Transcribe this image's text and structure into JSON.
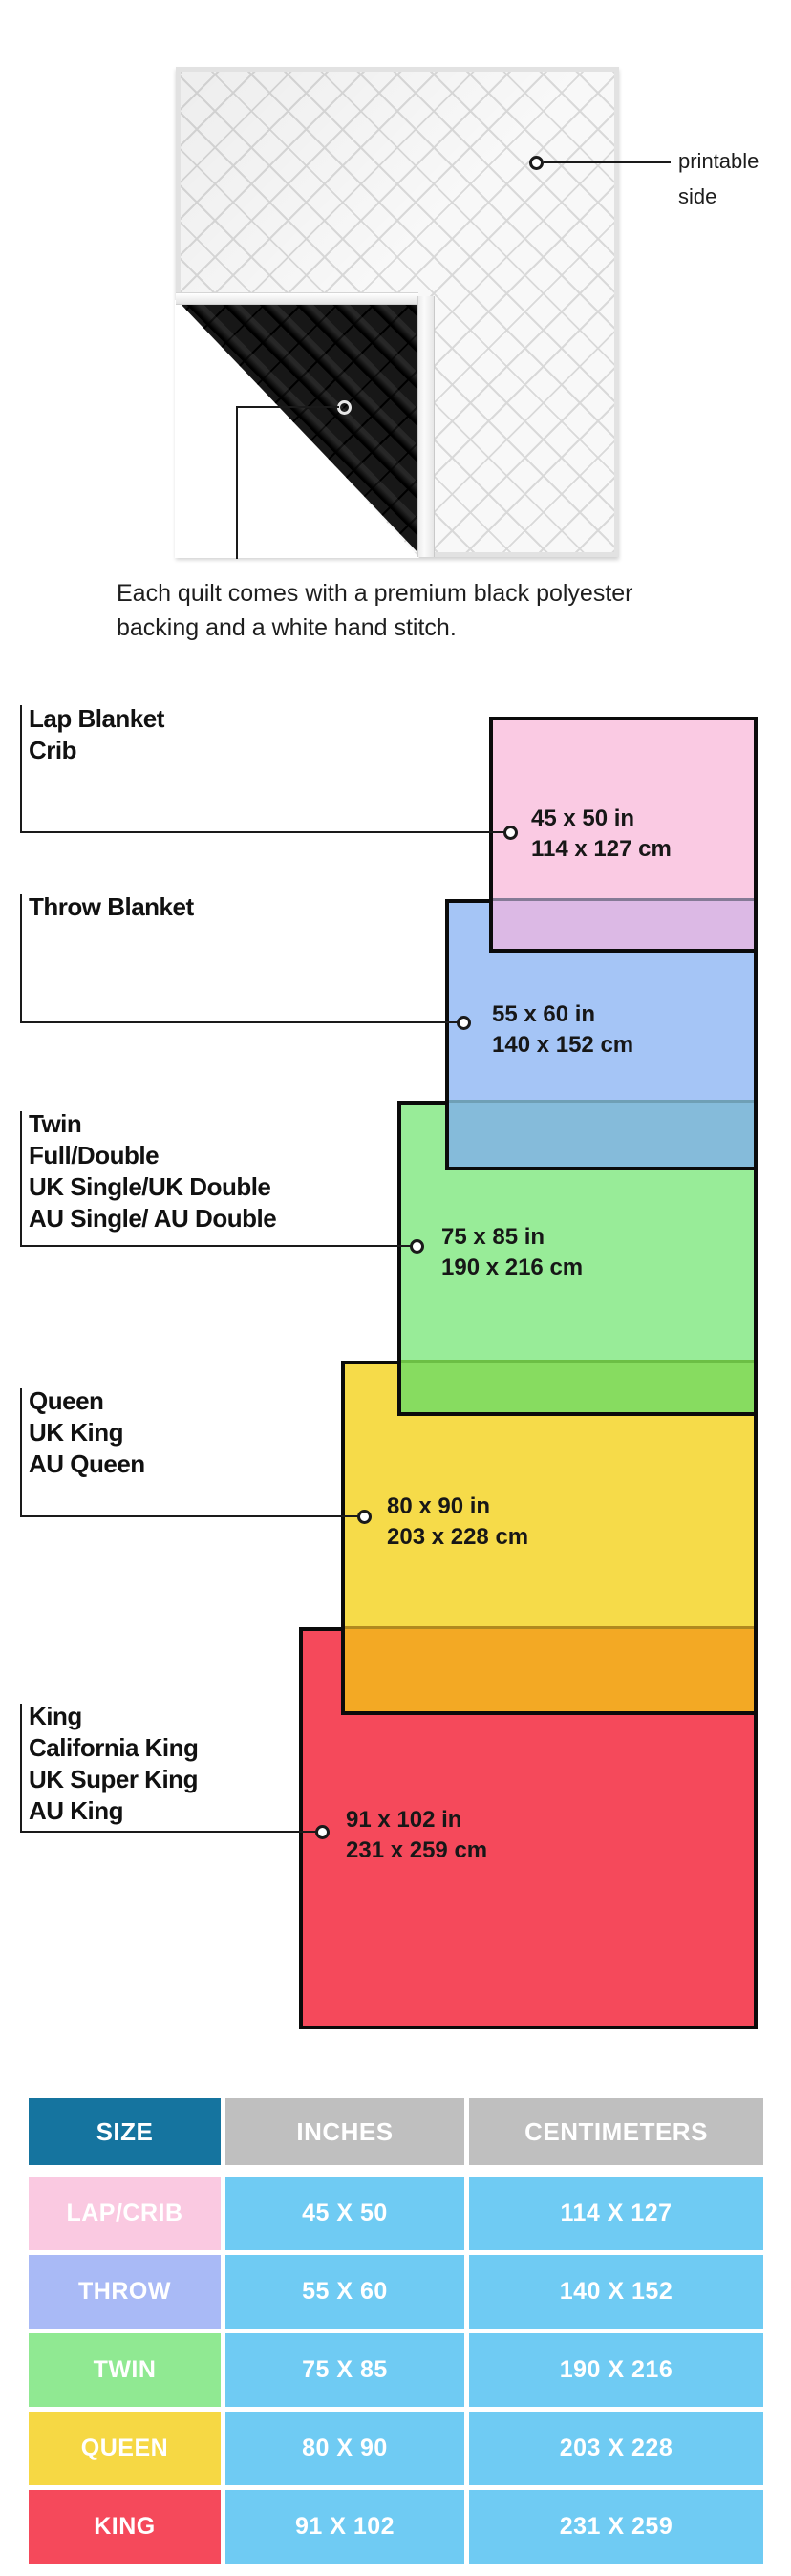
{
  "quilt": {
    "printable_line1": "printable",
    "printable_line2": "side",
    "caption_line1": "Each quilt comes with a premium black polyester",
    "caption_line2": "backing and a white hand stitch."
  },
  "diagram": {
    "sizes": [
      {
        "id": "lap",
        "labels": [
          "Lap Blanket",
          "Crib"
        ],
        "inches": "45 x 50 in",
        "cm": "114 x 127 cm",
        "color": "#FACAE3"
      },
      {
        "id": "throw",
        "labels": [
          "Throw Blanket"
        ],
        "inches": "55 x 60 in",
        "cm": "140 x 152 cm",
        "color": "#A5C5F6"
      },
      {
        "id": "twin",
        "labels": [
          "Twin",
          "Full/Double",
          "UK Single/UK Double",
          "AU Single/ AU Double"
        ],
        "inches": "75 x 85 in",
        "cm": "190 x 216 cm",
        "color": "#98EC98"
      },
      {
        "id": "queen",
        "labels": [
          "Queen",
          "UK King",
          "AU Queen"
        ],
        "inches": "80 x 90 in",
        "cm": "203 x 228 cm",
        "color": "#F6DB49"
      },
      {
        "id": "king",
        "labels": [
          "King",
          "California King",
          "UK Super King",
          "AU King"
        ],
        "inches": "91 x 102 in",
        "cm": "231 x 259 cm",
        "color": "#F5495B"
      }
    ],
    "overlap_colors": {
      "pink_over_blue": "#DCB9E5",
      "blue_over_green": "#85BBDA",
      "green_over_yellow": "#87DC60",
      "yellow_over_red": "#F3A924"
    }
  },
  "table": {
    "headers": [
      "SIZE",
      "INCHES",
      "CENTIMETERS"
    ],
    "rows": [
      {
        "size": "LAP/CRIB",
        "inches": "45 X 50",
        "centimeters": "114 X 127",
        "label_color": "#FAC9E1"
      },
      {
        "size": "THROW",
        "inches": "55 X 60",
        "centimeters": "140 X 152",
        "label_color": "#A9BAF6"
      },
      {
        "size": "TWIN",
        "inches": "75 X 85",
        "centimeters": "190 X 216",
        "label_color": "#90E992"
      },
      {
        "size": "QUEEN",
        "inches": "80 X 90",
        "centimeters": "203 X 228",
        "label_color": "#F6D844"
      },
      {
        "size": "KING",
        "inches": "91 X 102",
        "centimeters": "231 X 259",
        "label_color": "#F5495B"
      }
    ],
    "colors": {
      "header_size_bg": "#15749F",
      "header_bg": "#BFBFBF",
      "cell_bg": "#6FCBF3",
      "text": "#FFFFFF"
    }
  }
}
